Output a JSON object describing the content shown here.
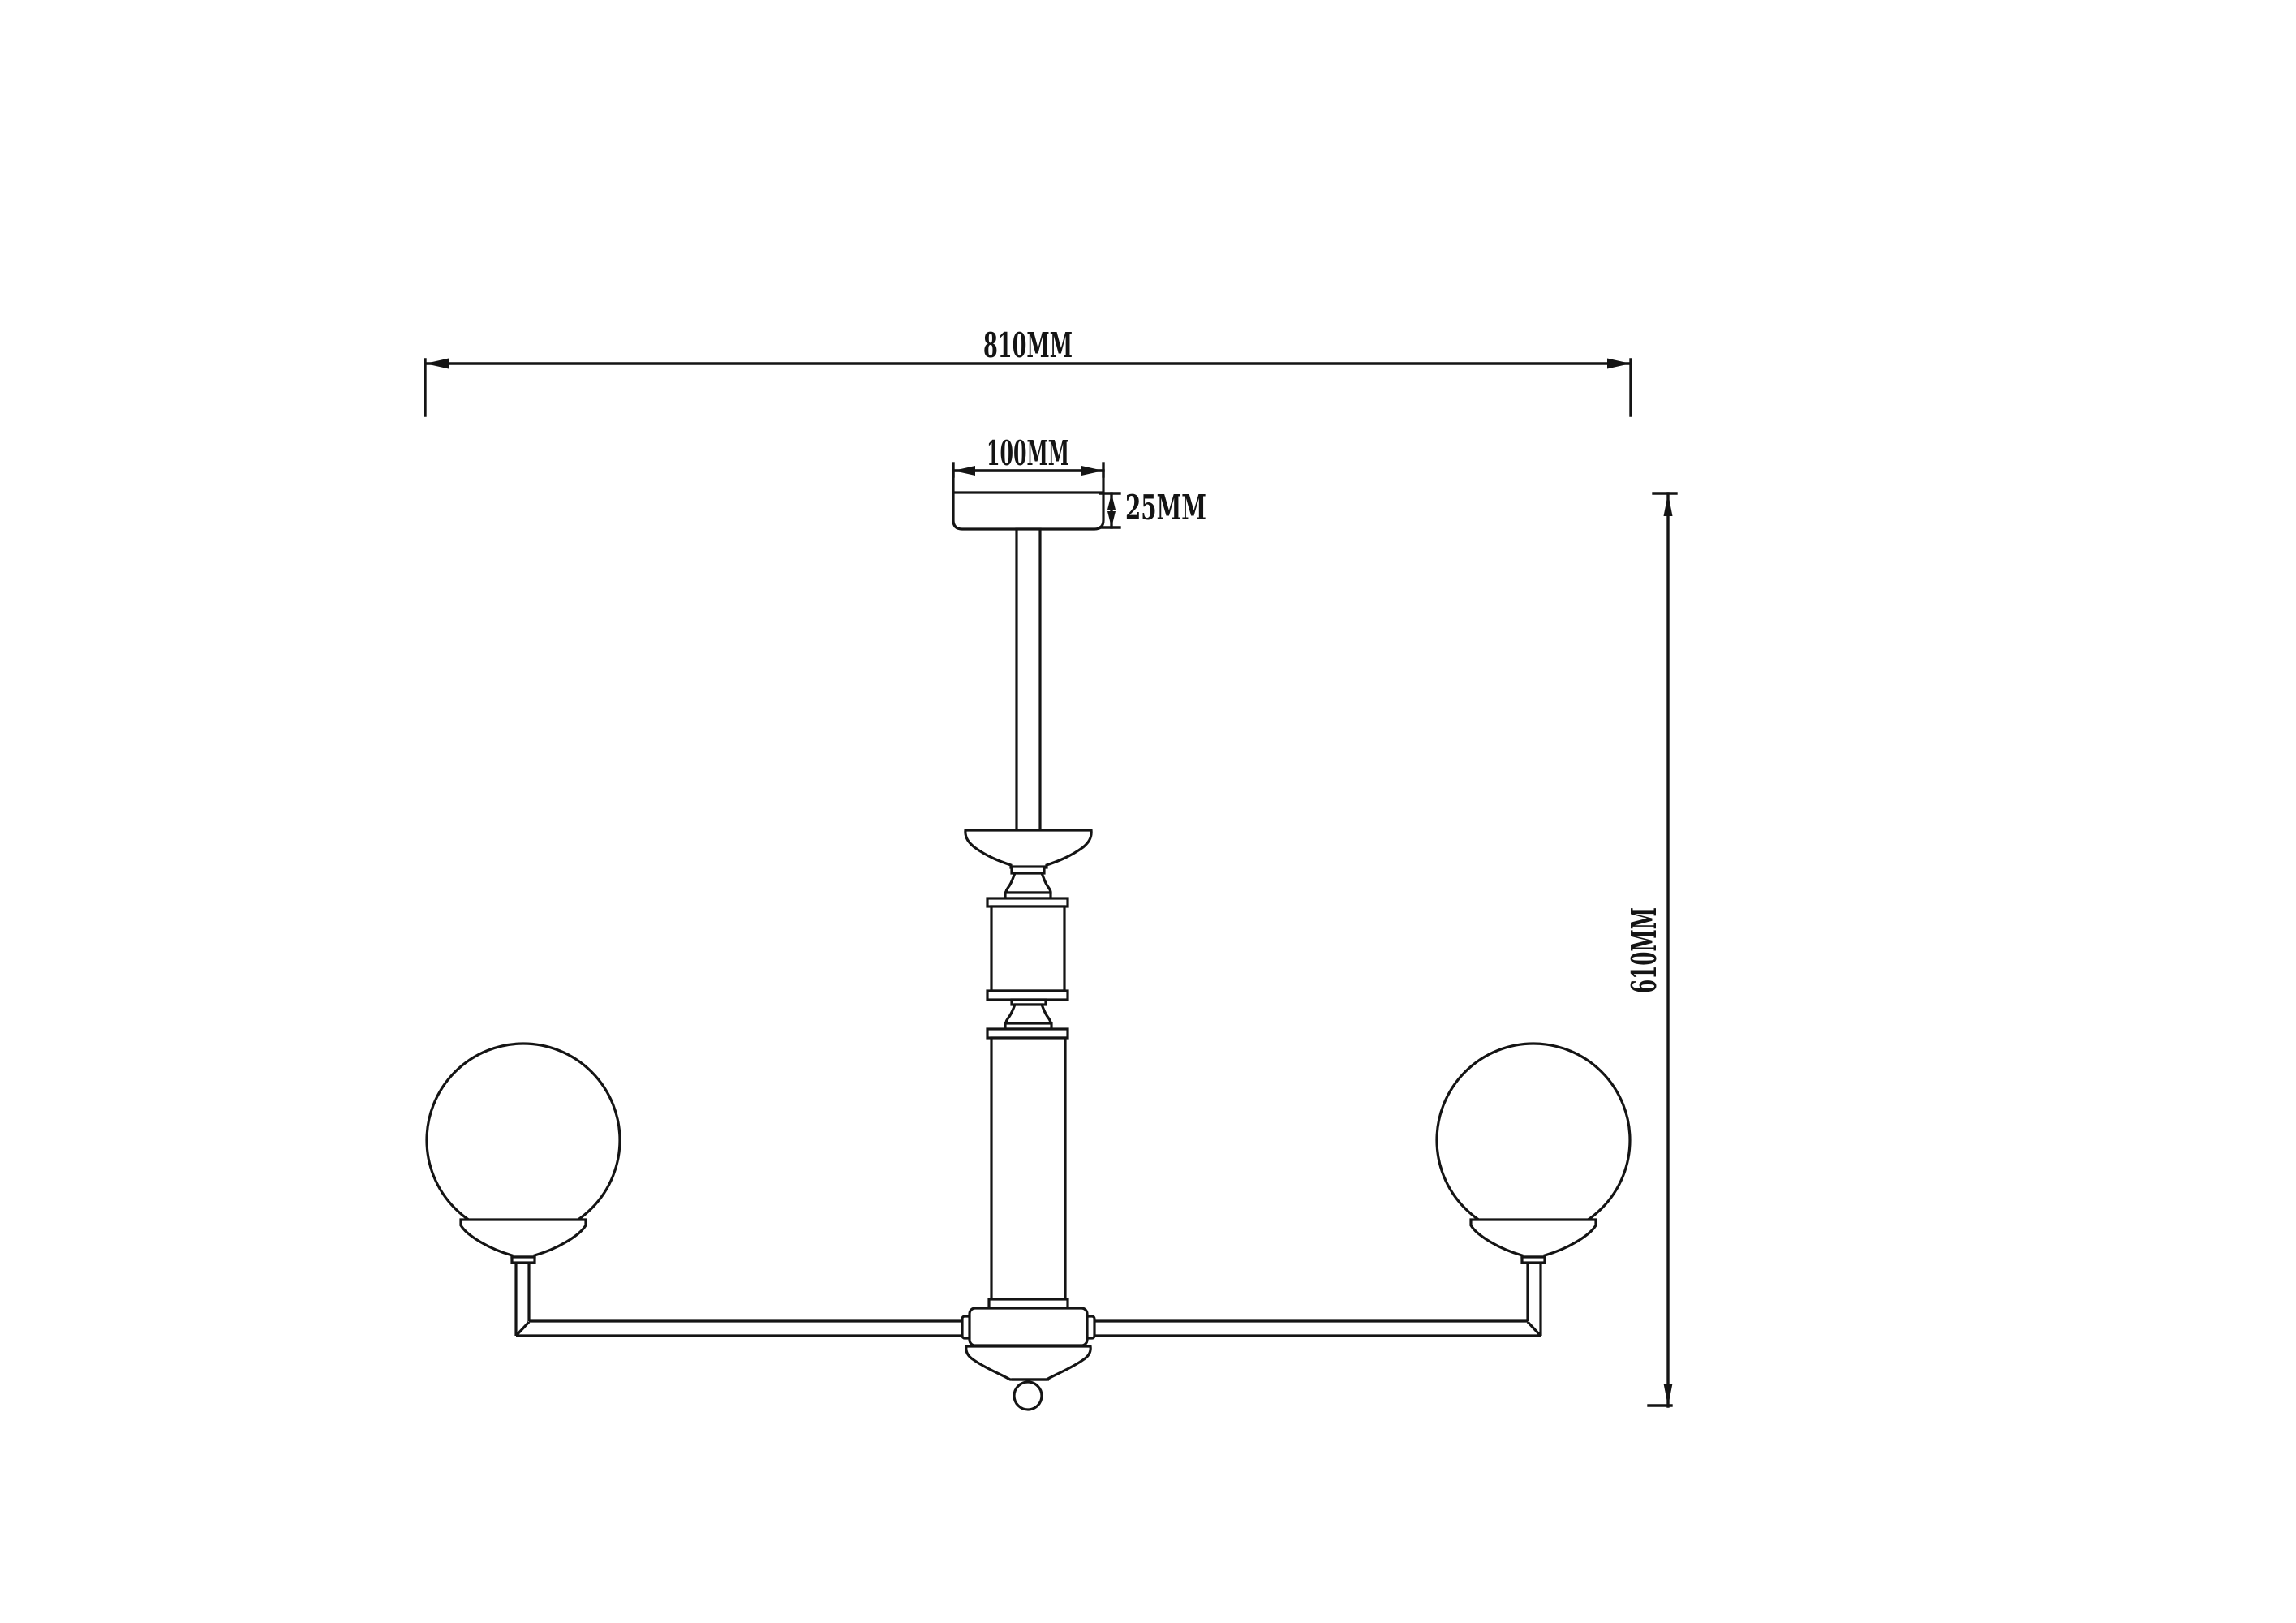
{
  "dimensions": {
    "overall_width": {
      "label": "810MM",
      "value_mm": 810
    },
    "canopy_width": {
      "label": "100MM",
      "value_mm": 100
    },
    "canopy_height": {
      "label": "25MM",
      "value_mm": 25
    },
    "overall_height": {
      "label": "610MM",
      "value_mm": 610
    }
  },
  "colors": {
    "line": "#141414",
    "background": "#ffffff"
  }
}
